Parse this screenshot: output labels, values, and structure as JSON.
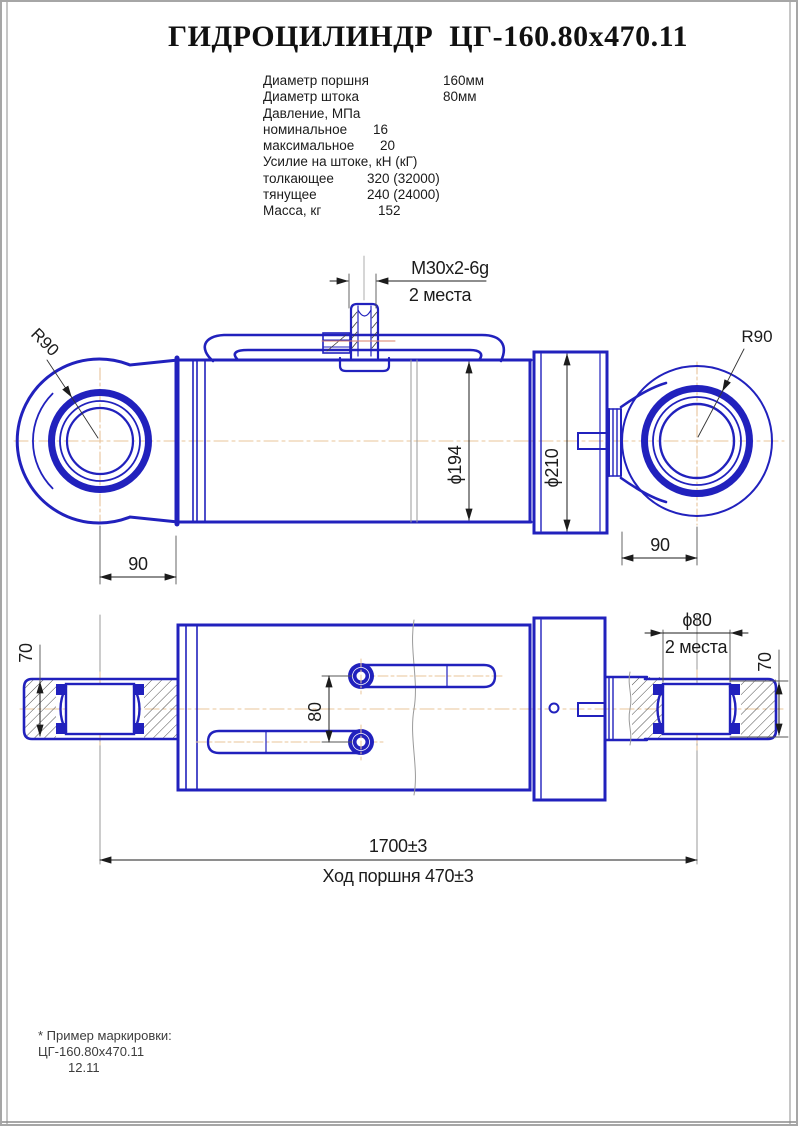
{
  "title": "ГИДРОЦИЛИНДР  ЦГ-160.80х470.11",
  "specs": {
    "rows": [
      {
        "label": "Диаметр поршня",
        "value": "160мм"
      },
      {
        "label": "Диаметр штока",
        "value": "80мм"
      },
      {
        "label": "Давление, МПа",
        "value": ""
      },
      {
        "label": "номинальное",
        "value": "16"
      },
      {
        "label": "максимальное",
        "value": "20"
      },
      {
        "label": "Усилие на штоке, кН (кГ)",
        "value": ""
      },
      {
        "label": "толкающее",
        "value": "320 (32000)"
      },
      {
        "label": "тянущее",
        "value": "240 (24000)"
      },
      {
        "label": "Масса, кг",
        "value": "152"
      }
    ]
  },
  "drawing": {
    "colors": {
      "line_blue": "#2121bd",
      "centerline_tan": "#e8c49a",
      "fitting_centerline_red": "#d9806a",
      "dimension_black": "#1c1c1c",
      "break_gray": "#8c8c8c"
    },
    "labels": {
      "thread": "М30х2-6g",
      "thread_places": "2 места",
      "radius_left": "R90",
      "radius_right": "R90",
      "bore_diameter": "ϕ194",
      "gland_diameter": "ϕ210",
      "eye_offset_left": "90",
      "eye_offset_right": "90",
      "pin_width_left": "70",
      "pin_width_right": "70",
      "port_spacing": "80",
      "pin_diameter": "ϕ80",
      "pin_places": "2 места",
      "overall_length": "1700±3",
      "piston_stroke": "Ход поршня 470±3"
    }
  },
  "footer": {
    "note": "* Пример маркировки:",
    "marking": "ЦГ-160.80х470.11",
    "date": "12.11"
  }
}
